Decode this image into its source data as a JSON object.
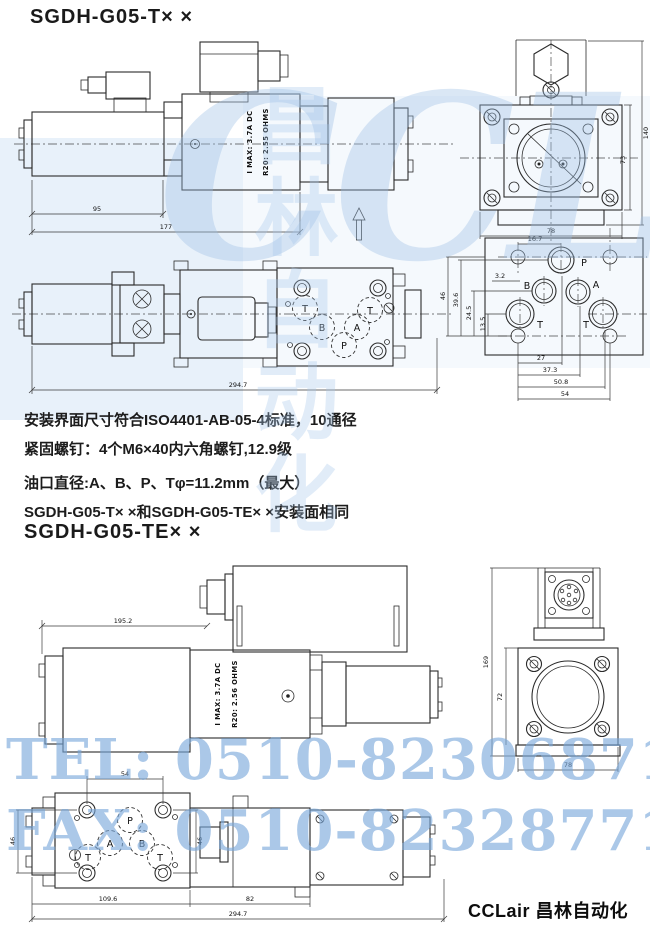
{
  "page": {
    "title_t": "SGDH-G05-T× ×",
    "title_te": "SGDH-G05-TE× ×",
    "footer_brand": "CCLair 昌林自动化"
  },
  "watermark": {
    "brand": "CCLair",
    "brand_cn": "昌林自动化",
    "tel": "TEL: 0510-82306871",
    "fax": "FAX: 0510-82328771",
    "color": "#9fc2e6"
  },
  "notes": {
    "line1": "安装界面尺寸符合ISO4401-AB-05-4标准，10通径",
    "line2": "紧固螺钉：4个M6×40内六角螺钉,12.9级",
    "line3": "油口直径:A、B、P、Tφ=11.2mm（最大）",
    "line4": "SGDH-G05-T× ×和SGDH-G05-TE× ×安装面相同"
  },
  "t_side": {
    "dim_coil": "95",
    "dim_body": "177",
    "body_text_1": "I MAX: 3.7A DC",
    "body_text_2": "R20: 2.55 OHMS"
  },
  "t_end": {
    "dim_total_height": "140",
    "dim_body_height": "73",
    "dim_width": "78"
  },
  "t_bottom": {
    "dim_total": "294.7",
    "port_t1": "T",
    "port_b": "B",
    "port_a": "A",
    "port_p": "P",
    "port_t2": "T"
  },
  "t_face": {
    "port_p": "P",
    "port_b": "B",
    "port_a": "A",
    "port_t1": "T",
    "port_t2": "T",
    "dim_16_7": "16.7",
    "dim_3_2": "3.2",
    "dim_46": "46",
    "dim_39_6": "39.6",
    "dim_24_5": "24.5",
    "dim_13_5": "13.5",
    "dim_27": "27",
    "dim_37_3": "37.3",
    "dim_50_8": "50.8",
    "dim_54": "54"
  },
  "te_side": {
    "dim_top": "195.2",
    "body_text_1": "I MAX: 3.7A DC",
    "body_text_2": "R20: 2.56 OHMS"
  },
  "te_end": {
    "dim_total_height": "169",
    "dim_body_height": "72",
    "dim_width": "78"
  },
  "te_bottom": {
    "dim_bolt_x": "54",
    "dim_bolt_y_left": "46",
    "dim_bolt_y_right": "46",
    "dim_left_len": "109.6",
    "dim_mid_len": "82",
    "dim_total": "294.7",
    "port_p": "P",
    "port_a": "A",
    "port_b": "B",
    "port_t1": "T",
    "port_t2": "T"
  }
}
